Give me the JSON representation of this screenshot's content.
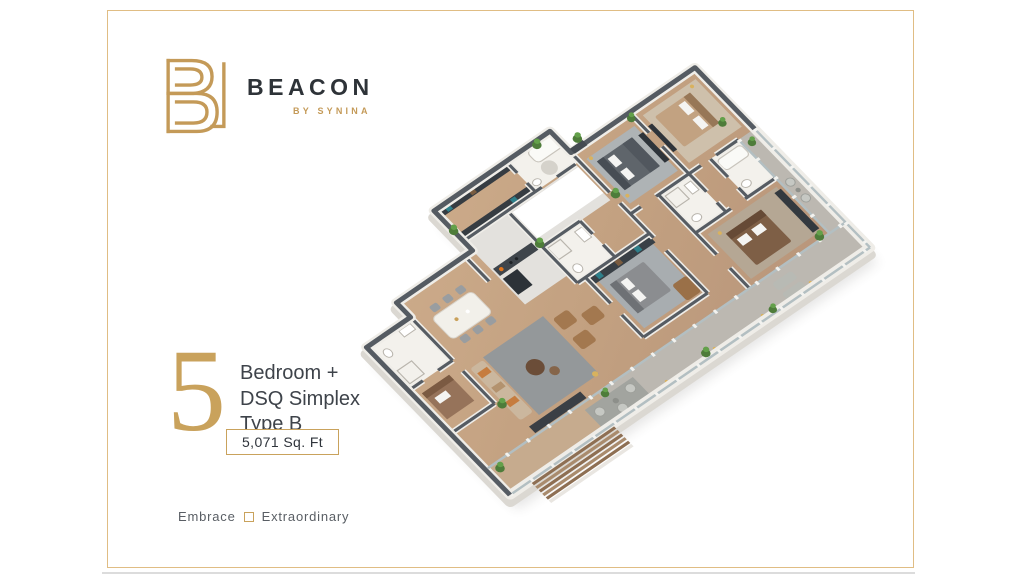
{
  "page": {
    "background": "#ffffff",
    "frame_color": "#e0bd84",
    "bottom_edge_color": "#dcdcdc"
  },
  "brand": {
    "name": "BEACON",
    "subtitle": "BY SYNINA",
    "logo_gold": "#c49a58",
    "name_color": "#2e3338"
  },
  "unit": {
    "number": "5",
    "lines": [
      "Bedroom +",
      "DSQ Simplex",
      "Type B"
    ],
    "area_label": "5,071 Sq. Ft",
    "accent_color": "#c9a25c",
    "text_color": "#3e434a"
  },
  "tagline": {
    "left": "Embrace",
    "right": "Extraordinary"
  },
  "floorplan": {
    "description": "Isometric 3D render of a 5 bedroom + DSQ simplex apartment, type B, with living room, dining, kitchen, five bedrooms, bathrooms and wrap-around balcony with timber deck steps",
    "palette": {
      "wood_floor": "#c7a685",
      "wall_dark": "#555b62",
      "wall_white": "#efede8",
      "bathroom_white": "#f3f1ec",
      "balcony_gray": "#bcb8b1",
      "rug_gray": "#9aa0a3",
      "plant_green": "#4e7c3a",
      "deck_wood": "#8e6f53",
      "glass_rail": "#b3bfc2",
      "sofa_brown": "#a3784f",
      "accent_orange": "#e0741c"
    }
  }
}
